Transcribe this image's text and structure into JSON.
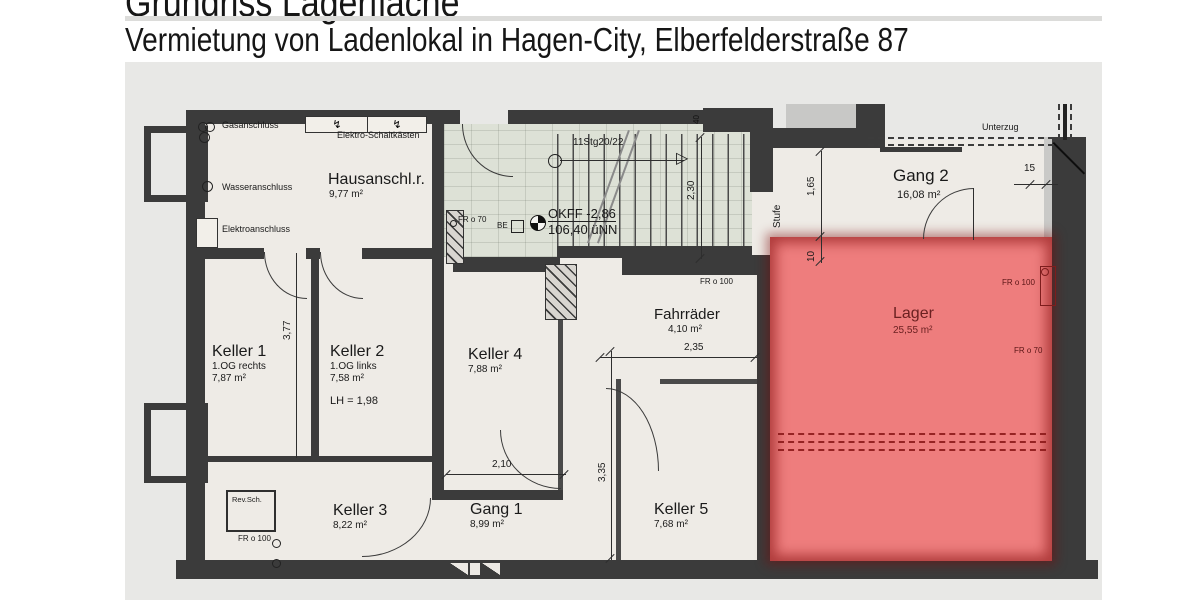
{
  "header": {
    "title": "Grundriss Lagerfläche",
    "subtitle": "Vermietung von Ladenlokal in Hagen-City, Elberfelderstraße 87"
  },
  "plan": {
    "rooms": {
      "hausanschluss": {
        "name": "Hausanschl.r.",
        "area": "9,77 m²"
      },
      "keller1": {
        "name": "Keller  1",
        "floor": "1.OG rechts",
        "area": "7,87 m²"
      },
      "keller2": {
        "name": "Keller  2",
        "floor": "1.OG links",
        "area": "7,58 m²",
        "clear_height": "LH = 1,98"
      },
      "keller3": {
        "name": "Keller  3",
        "area": "8,22 m²"
      },
      "keller4": {
        "name": "Keller  4",
        "area": "7,88 m²"
      },
      "gang1": {
        "name": "Gang 1",
        "area": "8,99 m²"
      },
      "keller5": {
        "name": "Keller  5",
        "area": "7,68 m²"
      },
      "fahrraeder": {
        "name": "Fahrräder",
        "area": "4,10 m²"
      },
      "gang2": {
        "name": "Gang 2",
        "area": "16,08 m²"
      },
      "lager": {
        "name": "Lager",
        "area": "25,55 m²"
      }
    },
    "annotations": {
      "gas": "Gasanschluss",
      "wasser": "Wasseranschluss",
      "elektro": "Elektroanschluss",
      "schaltkaesten": "Elektro-Schaltkästen",
      "stair_run": "11Stg20/22",
      "okff": "OKFF -2,86",
      "uenn": "106,40 üNN",
      "be": "BE",
      "stufe": "Stufe",
      "unterzug": "Unterzug",
      "revsch": "Rev.Sch.",
      "fr70": "FR o 70",
      "fr100": "FR o 100"
    },
    "dimensions": {
      "d230": "2,30",
      "d165": "1,65",
      "d10": "10",
      "d15": "15",
      "d40": "40",
      "d377": "3,77",
      "d210": "2,10",
      "d335": "3,35",
      "d235": "2,35"
    },
    "icons": {
      "stair_arrow": "▷",
      "breaker": "↯"
    },
    "colors": {
      "wall": "#3b3b3b",
      "floor": "#eeebe6",
      "tiles": "#dde1d6",
      "highlight": "#ee7d7d",
      "background": "#e8e8e6"
    }
  }
}
